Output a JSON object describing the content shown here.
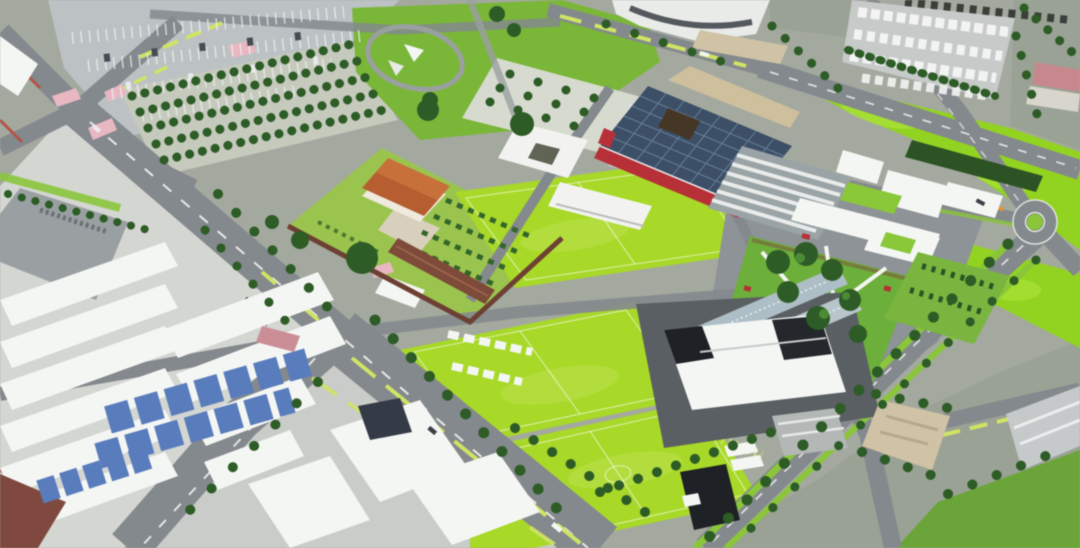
{
  "scene": {
    "kind": "aerial-3d-masterplan-render",
    "view": "oblique-birdseye",
    "features": [
      "surface-parking-lot",
      "tree-grid-parking",
      "circular-park",
      "orchard-plaza",
      "terraced-steps",
      "walled-garden-cascina",
      "expo-hall",
      "exhibition-annex",
      "courtyard-building",
      "arena",
      "sports-pitches",
      "meadow",
      "campus-block",
      "courtyard-garden-walkways",
      "glass-pavilions",
      "roundabout",
      "tree-lined-boulevard",
      "tree-lined-avenue",
      "industrial-rooftops",
      "solar-panels",
      "truck-depot",
      "dark-plaza-sports-hall",
      "gravel-yard",
      "lawn",
      "roads-network"
    ],
    "palette": {
      "base": "#a4a99f",
      "photo_muted": "#9aa296",
      "road": "#84898d",
      "road_light": "#9aa0a3",
      "plaza_dark": "#5a5f63",
      "lane_white": "#f2f4f2",
      "lane_lime": "#cfe36a",
      "verge_lime": "#9ccc44",
      "lane_orange": "#e09440",
      "red_curb": "#b0544a",
      "asphalt_light": "#bcc1c4",
      "industrial_pale": "#d4d6d2",
      "pitch_green": "#a9d72f",
      "pitch_light": "#c6e465",
      "meadow_green": "#94d229",
      "park_green": "#7cb53d",
      "garden_green": "#9cc353",
      "verge_green": "#8cc440",
      "lawn_green": "#6da33c",
      "hedge_dark": "#2e5227",
      "tree_dark": "#2f5b28",
      "tree_mid": "#447a31",
      "roof_white": "#f4f6f3",
      "roof_shadow": "#c7cbca",
      "roof_gray": "#9aa0a2",
      "roof_black": "#1e2125",
      "roof_navy": "#343b46",
      "expo_roof": "#3d4f66",
      "expo_grid": "#7288a2",
      "accent_red": "#b23138",
      "cascina_roof": "#c4713d",
      "brick_wall": "#6b4034",
      "barn_brown": "#7c4a3b",
      "solar_blue": "#5b7cba",
      "gravel_tan": "#cfc3a6",
      "crosswalk_pink": "#e6b8c2",
      "glass_blue": "#b9c6cc",
      "pink_roof": "#c4898c"
    }
  }
}
